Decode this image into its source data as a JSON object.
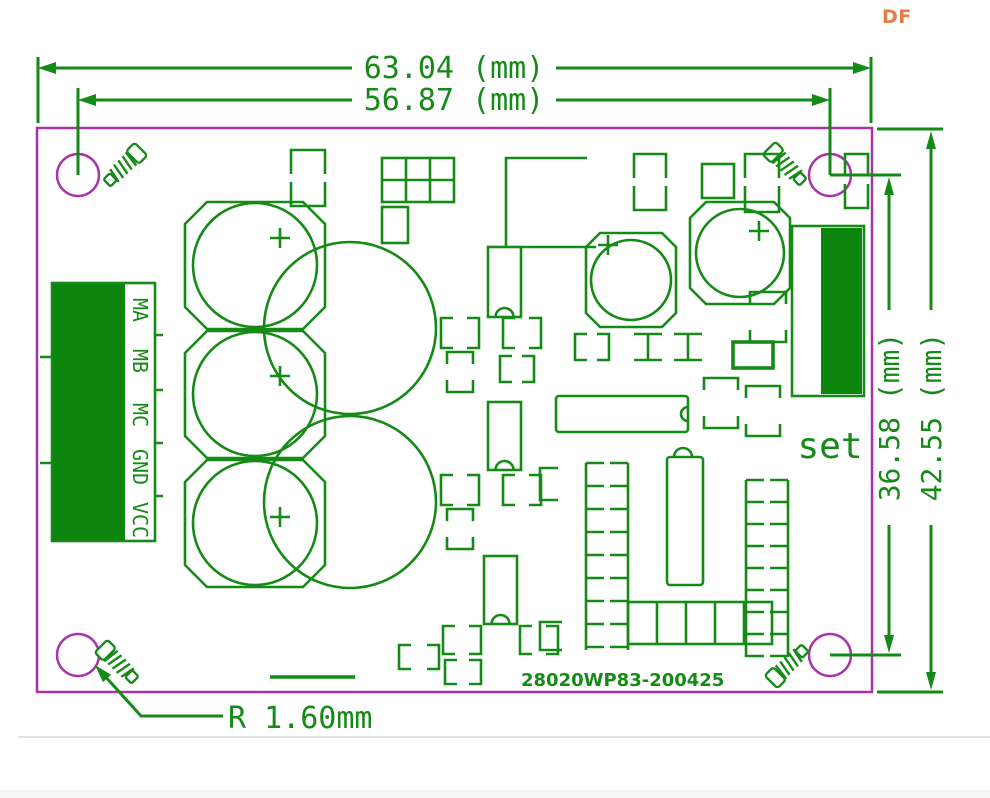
{
  "page": {
    "logo": "DF"
  },
  "drawing": {
    "dimensions": {
      "width_outer": "63.04 (mm)",
      "width_holes": "56.87 (mm)",
      "height_holes": "36.58 (mm)",
      "height_outer": "42.55 (mm)",
      "hole_radius": "R 1.60mm"
    },
    "labels": {
      "set": "set",
      "part_number": "28020WP83-200425",
      "connector_pins": [
        "MA",
        "MB",
        "MC",
        "GND",
        "VCC"
      ]
    }
  },
  "colors": {
    "silkscreen_green": "#168a16",
    "silkscreen_fill_green": "#0c850c",
    "board_outline_magenta": "#a832a8",
    "logo_orange": "#e87a45",
    "divider_gray": "#e3e3e3",
    "background": "#ffffff"
  }
}
